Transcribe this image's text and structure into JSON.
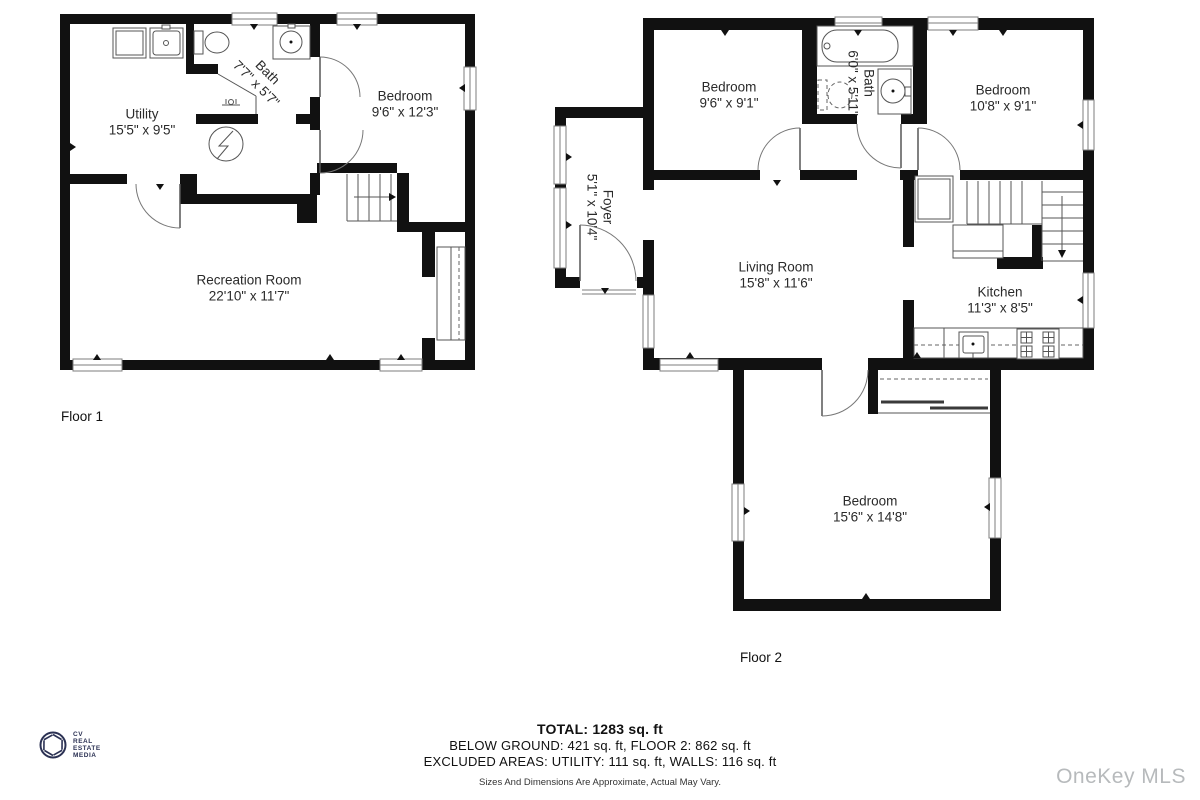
{
  "page": {
    "background": "#ffffff"
  },
  "floor1": {
    "label": "Floor 1",
    "rooms": {
      "utility": {
        "name": "Utility",
        "dims": "15'5\" x 9'5\""
      },
      "bath": {
        "name": "Bath",
        "dims": "7'7\" x 5'7\""
      },
      "bedroom": {
        "name": "Bedroom",
        "dims": "9'6\" x 12'3\""
      },
      "recreation": {
        "name": "Recreation Room",
        "dims": "22'10\" x 11'7\""
      }
    }
  },
  "floor2": {
    "label": "Floor 2",
    "rooms": {
      "bedroom_left": {
        "name": "Bedroom",
        "dims": "9'6\" x 9'1\""
      },
      "bath": {
        "name": "Bath",
        "dims": "6'0\" x 5'11\""
      },
      "bedroom_right": {
        "name": "Bedroom",
        "dims": "10'8\" x 9'1\""
      },
      "foyer": {
        "name": "Foyer",
        "dims": "5'1\" x 10'4\""
      },
      "living": {
        "name": "Living Room",
        "dims": "15'8\" x 11'6\""
      },
      "kitchen": {
        "name": "Kitchen",
        "dims": "11'3\" x 8'5\""
      },
      "bedroom_lower": {
        "name": "Bedroom",
        "dims": "15'6\" x 14'8\""
      }
    }
  },
  "summary": {
    "total": "TOTAL: 1283 sq. ft",
    "areas": "BELOW GROUND: 421 sq. ft, FLOOR 2: 862 sq. ft",
    "excluded": "EXCLUDED AREAS: UTILITY: 111 sq. ft, WALLS: 116 sq. ft",
    "disclaimer": "Sizes And Dimensions Are Approximate, Actual May Vary."
  },
  "branding": {
    "logo_lines": [
      "CV",
      "REAL",
      "ESTATE",
      "MEDIA"
    ],
    "logo_color": "#2b3153",
    "watermark": "OneKey MLS",
    "watermark_color": "#b7babc",
    "wall_color": "#111111"
  }
}
